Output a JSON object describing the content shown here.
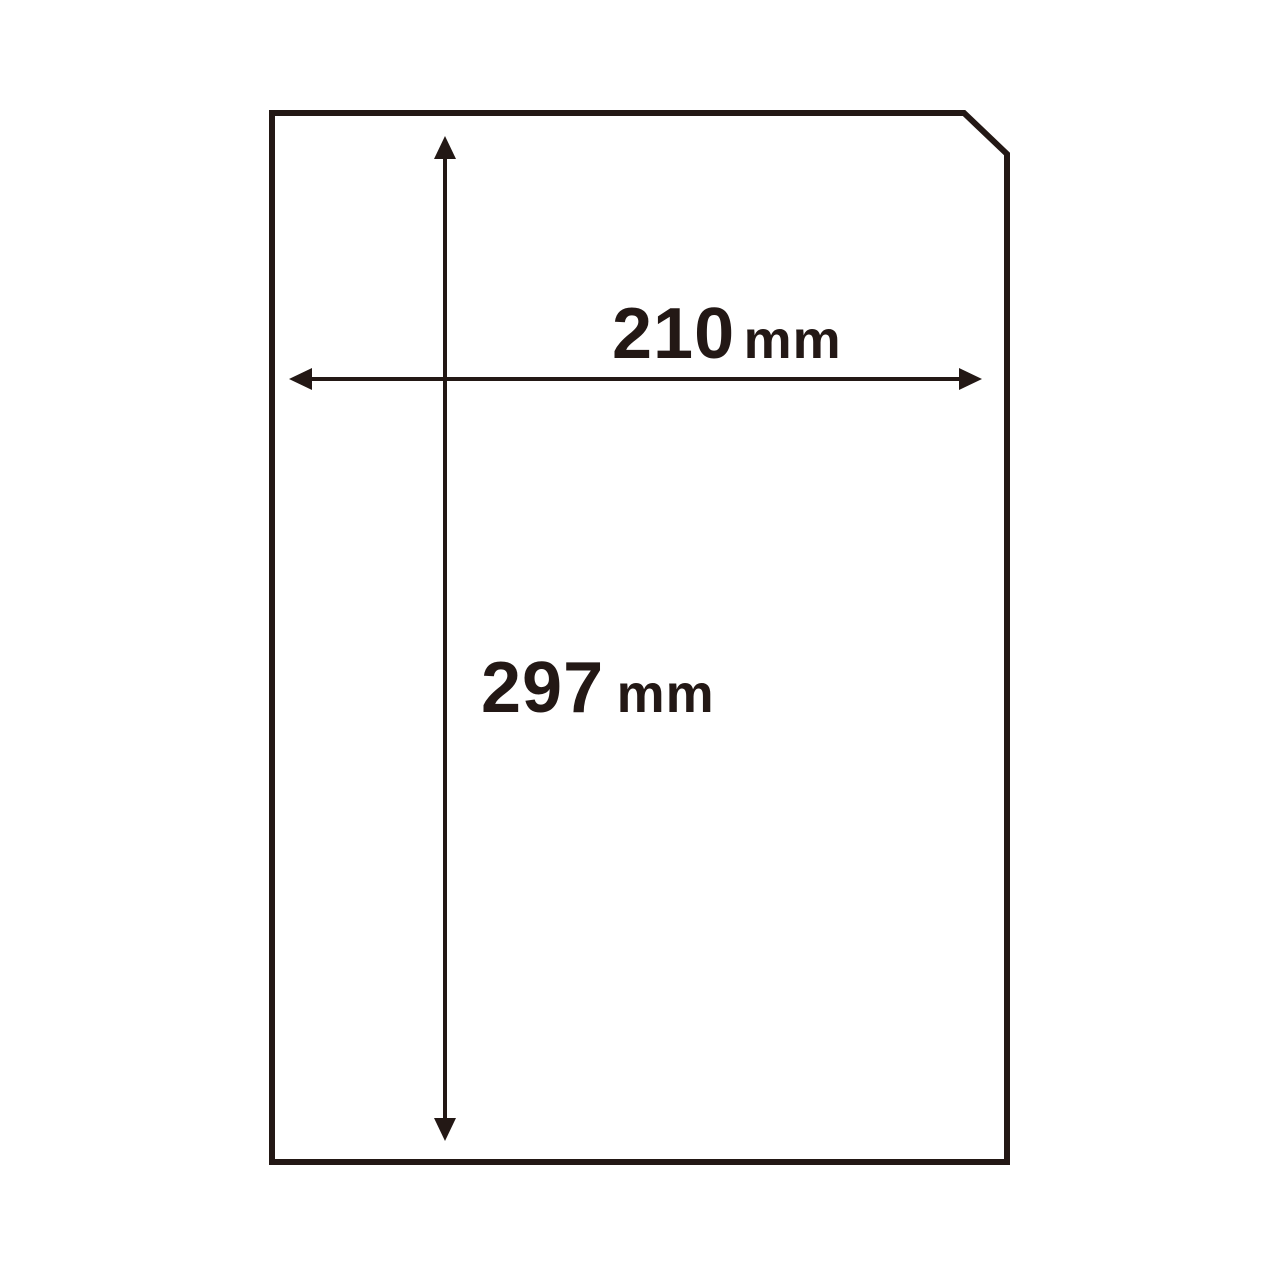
{
  "page": {
    "background": "#ffffff"
  },
  "colors": {
    "line": "#231815"
  },
  "diagram": {
    "subject": "a4-paper-sheet",
    "width_dimension": {
      "value": "210",
      "unit": "mm"
    },
    "height_dimension": {
      "value": "297",
      "unit": "mm"
    }
  }
}
